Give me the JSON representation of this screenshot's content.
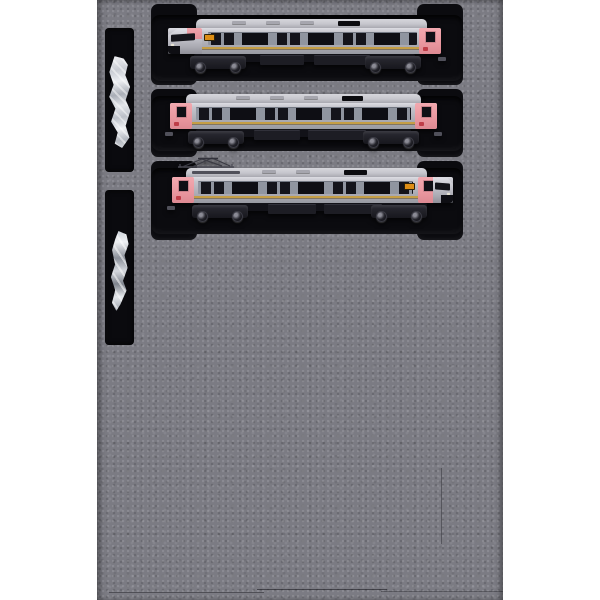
{
  "scene": {
    "type": "product-photo",
    "subject": "Three-car N-scale model train set stored in a speckled grey foam packaging tray with two accessory parts-bag slots on the left",
    "background_color": "#ffffff"
  },
  "foam": {
    "base_color": "#7b7b83",
    "speckle_light": "#90909a",
    "speckle_dark": "#63636b",
    "recess_color": "#0b0b0f",
    "recess_count": 3,
    "accessory_slot_count": 2
  },
  "cars": [
    {
      "id": "car-1",
      "slot": "top",
      "cab_end": "left",
      "pantograph": false,
      "body_color": "#b6b6be",
      "end_band_color": "#ec9da5",
      "stripe_color": "#c59e45",
      "window_color": "#14141b",
      "roof_color": "#c9c9cf",
      "destination_sign_color": "#dd8d15"
    },
    {
      "id": "car-2",
      "slot": "middle",
      "cab_end": "none",
      "pantograph": false,
      "body_color": "#b6b6be",
      "end_band_color": "#ec9da5",
      "stripe_color": "#c59e45",
      "window_color": "#14141b",
      "roof_color": "#c9c9cf",
      "destination_sign_color": null
    },
    {
      "id": "car-3",
      "slot": "bottom",
      "cab_end": "right",
      "pantograph": true,
      "body_color": "#b6b6be",
      "end_band_color": "#ec9da5",
      "stripe_color": "#c59e45",
      "window_color": "#14141b",
      "roof_color": "#c9c9cf",
      "destination_sign_color": "#dd8d15"
    }
  ],
  "accessories": [
    {
      "id": "parts-bag-1",
      "slot": "upper-left",
      "appearance": "crinkled clear plastic bag with bright white highlights"
    },
    {
      "id": "parts-bag-2",
      "slot": "lower-left",
      "appearance": "smaller clear plastic bag with silver part inside"
    }
  ]
}
